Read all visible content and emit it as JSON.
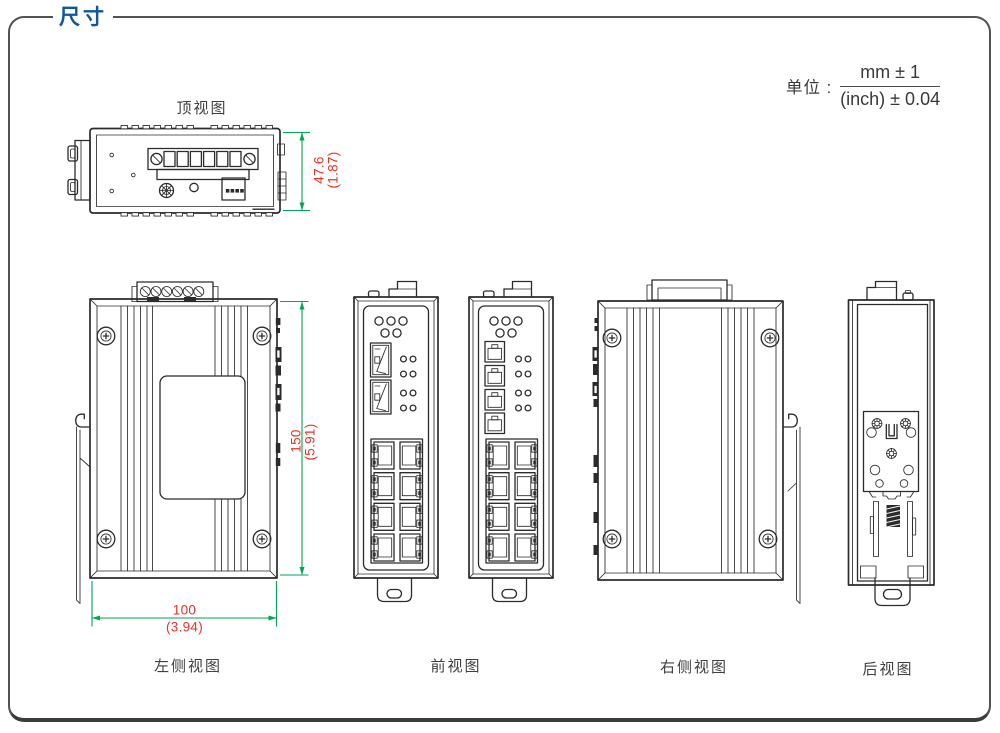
{
  "header": {
    "title": "尺寸"
  },
  "unit_note": {
    "label": "单位 :",
    "mm_tolerance": "mm ± 1",
    "inch_tolerance": "(inch) ± 0.04"
  },
  "view_labels": {
    "top": "顶视图",
    "left_side": "左侧视图",
    "front": "前视图",
    "right_side": "右侧视图",
    "rear": "后视图"
  },
  "dimensions": {
    "depth": {
      "mm": "47.6",
      "inch": "(1.87)"
    },
    "height": {
      "mm": "150",
      "inch": "(5.91)"
    },
    "width": {
      "mm": "100",
      "inch": "(3.94)"
    }
  },
  "colors": {
    "accent_blue": "#0d57a5",
    "dimension_line_green": "#00a651",
    "dimension_text_red": "#ee3124",
    "line_art_dark": "#2b2b2d"
  }
}
